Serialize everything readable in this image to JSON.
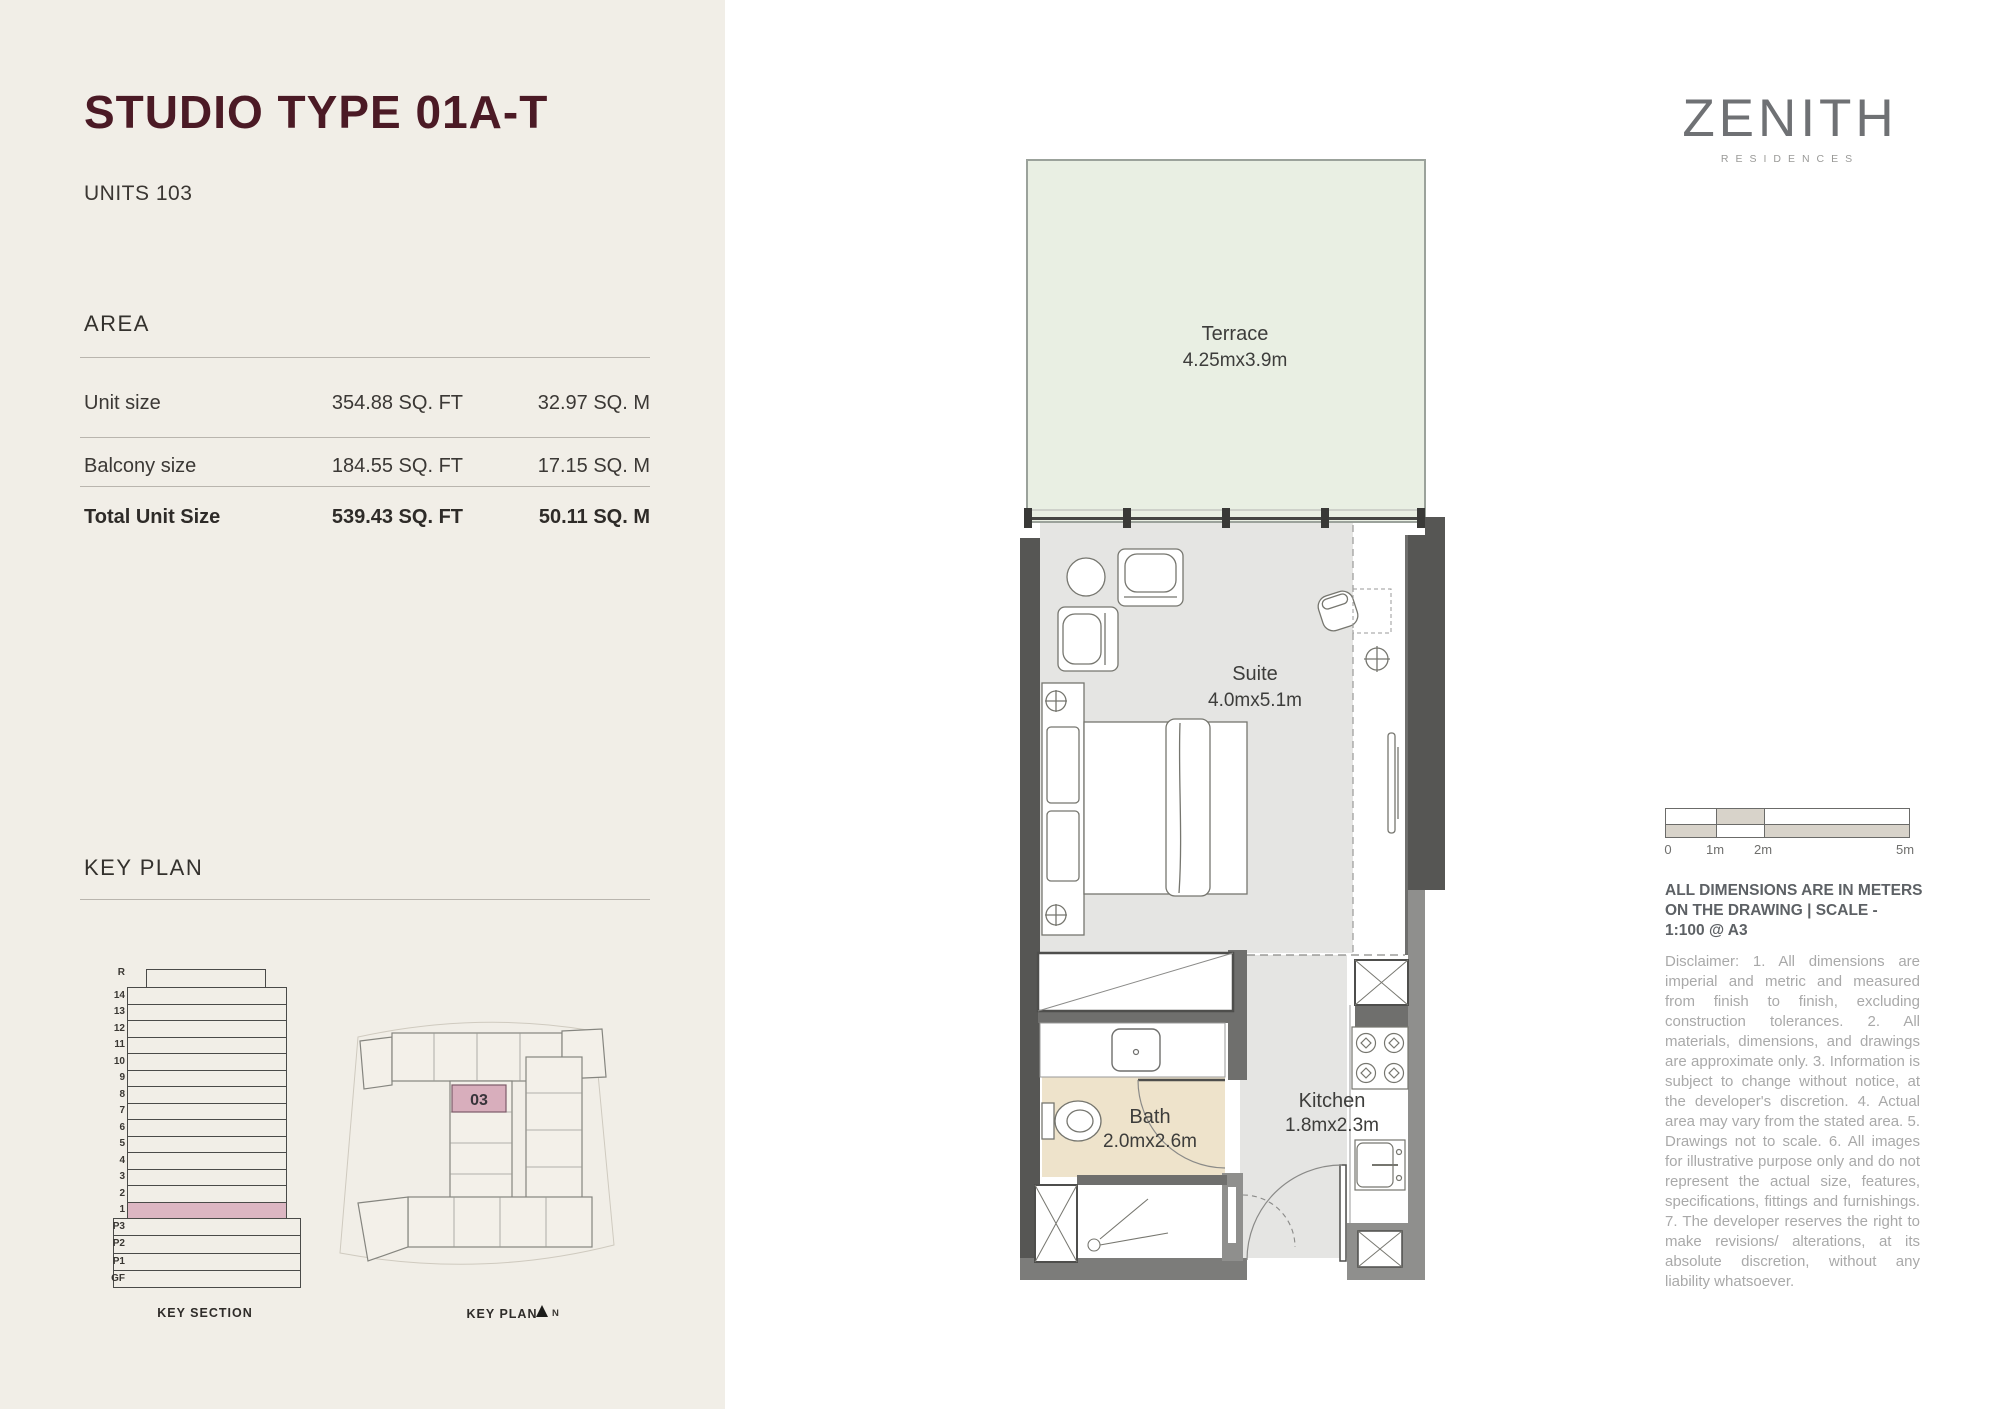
{
  "header": {
    "title": "STUDIO TYPE 01A-T",
    "units": "UNITS 103"
  },
  "area": {
    "heading": "AREA",
    "rows": [
      {
        "label": "Unit size",
        "sqft": "354.88 SQ. FT",
        "sqm": "32.97 SQ. M"
      },
      {
        "label": "Balcony size",
        "sqft": "184.55 SQ. FT",
        "sqm": "17.15 SQ. M"
      },
      {
        "label": "Total Unit Size",
        "sqft": "539.43 SQ. FT",
        "sqm": "50.11 SQ. M"
      }
    ]
  },
  "key_plan_section": {
    "heading": "KEY PLAN",
    "key_section": {
      "floors": [
        "R",
        "14",
        "13",
        "12",
        "11",
        "10",
        "9",
        "8",
        "7",
        "6",
        "5",
        "4",
        "3",
        "2",
        "1",
        "P3",
        "P2",
        "P1",
        "GF"
      ],
      "highlight_floor": "1",
      "highlight_color": "#dcb6c2",
      "caption": "KEY SECTION"
    },
    "key_plan_mini": {
      "unit_number": "03",
      "highlight_color": "#d8aebc",
      "caption": "KEY PLAN",
      "north_label": "N"
    }
  },
  "floorplan": {
    "rooms": {
      "terrace": {
        "name": "Terrace",
        "dims": "4.25mx3.9m"
      },
      "suite": {
        "name": "Suite",
        "dims": "4.0mx5.1m"
      },
      "bath": {
        "name": "Bath",
        "dims": "2.0mx2.6m"
      },
      "kitchen": {
        "name": "Kitchen",
        "dims": "1.8mx2.3m"
      }
    },
    "colors": {
      "terrace_fill": "#e9efe3",
      "floor_gray": "#e5e5e3",
      "bath_tan": "#eee3cb",
      "wall_dark": "#565654",
      "wall_mid": "#8f8f8d"
    }
  },
  "brand": {
    "logo": "ZENITH",
    "sub": "RESIDENCES"
  },
  "scale_bar": {
    "labels": [
      "0",
      "1m",
      "2m",
      "5m"
    ]
  },
  "notes": {
    "heading_line1": "ALL DIMENSIONS ARE IN METERS",
    "heading_line2": "ON THE DRAWING  |  SCALE -",
    "heading_line3": "1:100 @ A3",
    "disclaimer": "Disclaimer: 1. All dimensions are imperial and metric and measured from finish to finish, excluding construction tolerances. 2. All materials, dimensions, and drawings are approximate only. 3. Information is subject to change without notice, at the developer's discretion. 4. Actual area may vary from the stated area. 5. Drawings not to scale. 6. All images for illustrative purpose only and do not represent the actual size, features, specifications, fittings and furnishings. 7. The developer reserves the right to make revisions/ alterations, at its absolute discretion, without any liability whatsoever."
  }
}
